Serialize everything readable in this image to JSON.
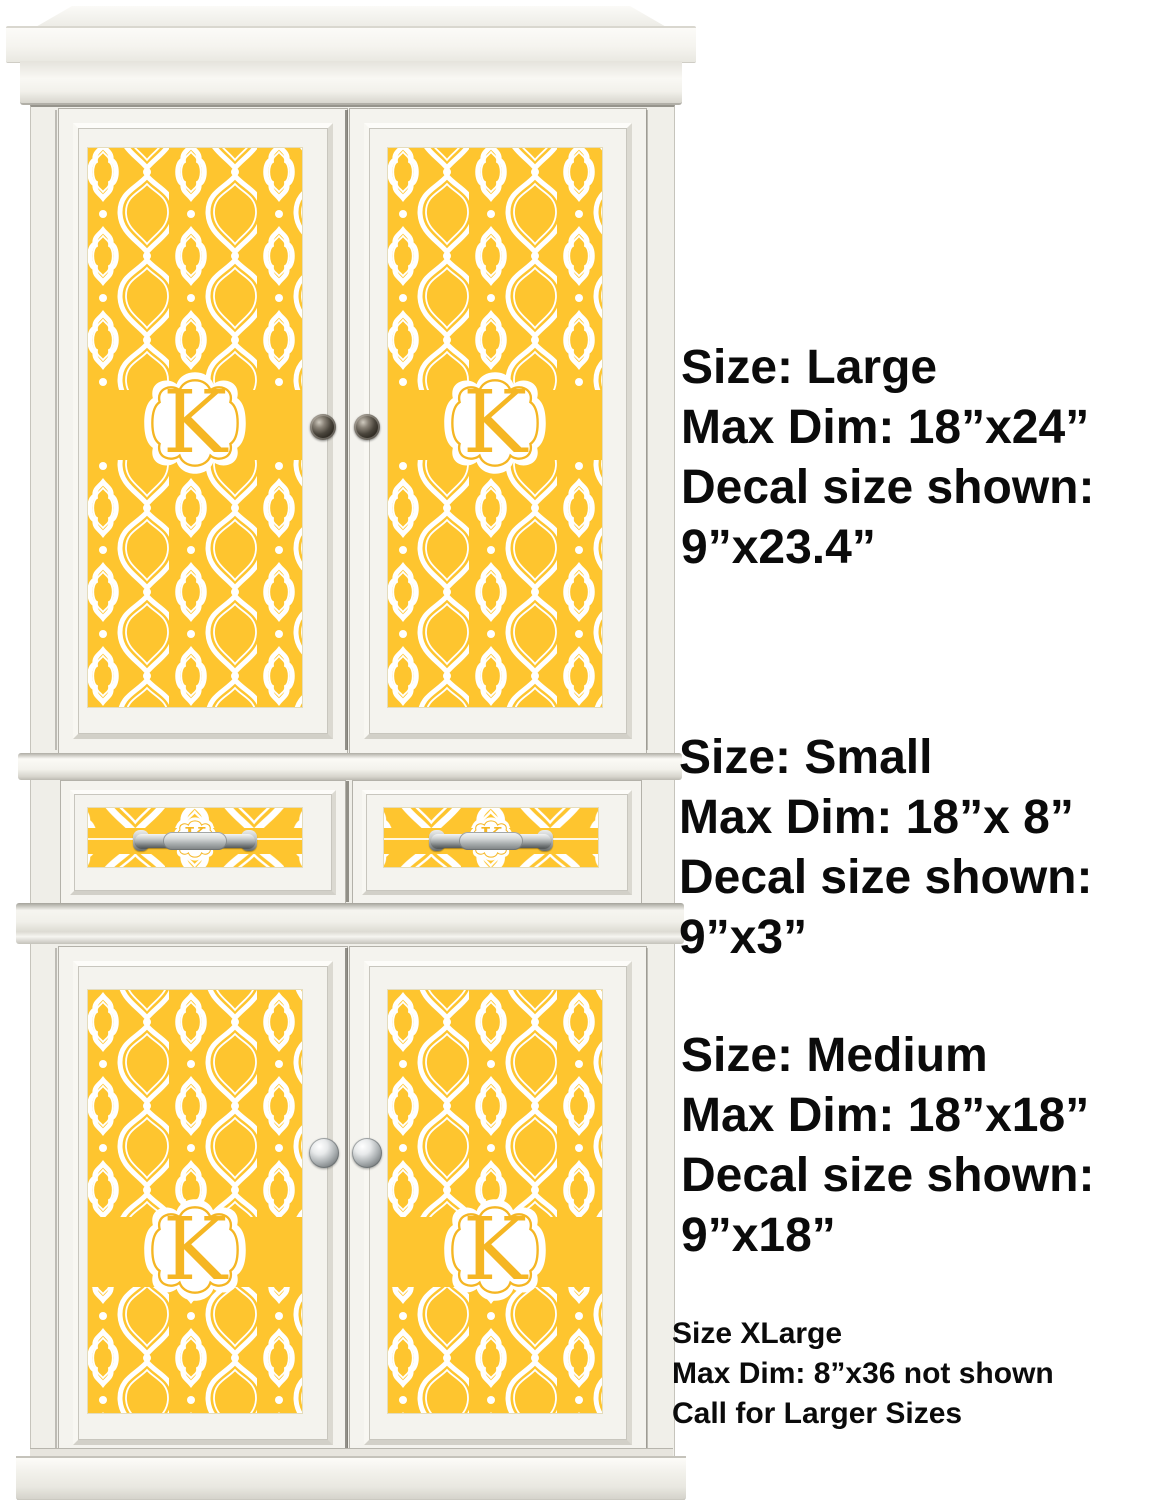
{
  "monogram": {
    "letter": "K"
  },
  "size_blocks": [
    {
      "id": "large",
      "lines": [
        "Size: Large",
        "Max Dim: 18”x24”",
        "Decal size shown:",
        "9”x23.4”"
      ]
    },
    {
      "id": "small",
      "lines": [
        "Size: Small",
        "Max Dim: 18”x 8”",
        "Decal size shown:",
        "9”x3”"
      ]
    },
    {
      "id": "medium",
      "lines": [
        "Size: Medium",
        "Max Dim: 18”x18”",
        "Decal size shown:",
        "9”x18”"
      ]
    },
    {
      "id": "xlarge",
      "lines": [
        "Size XLarge",
        "Max Dim: 8”x36 not shown",
        "Call for Larger Sizes"
      ]
    }
  ],
  "colors": {
    "decal_yellow": "#FEC52F",
    "decal_line_white": "#FFFFFF",
    "letter_yellow": "#F5B623",
    "text_black": "#0B0B0B",
    "cabinet_white": "#F3F2ED"
  }
}
